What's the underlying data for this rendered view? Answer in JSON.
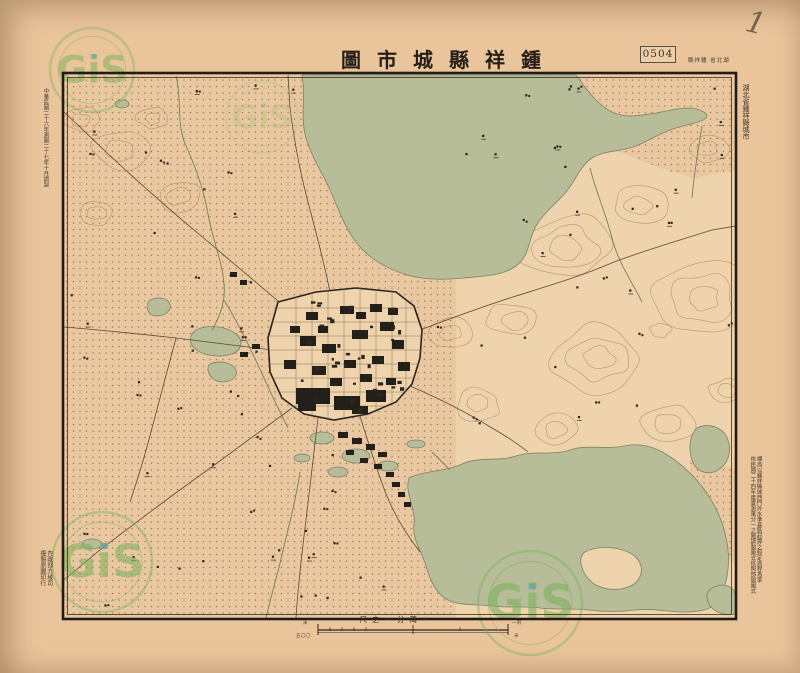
{
  "sheet": {
    "title": "鍾祥縣城市圖",
    "sheet_number": "0504",
    "series_note": "湖北省 鍾祥縣",
    "margin_top_right": "湖北省鍾祥縣城市",
    "margin_top_left": "中華民國二十六年測圖二十七年十月調製",
    "margin_right_note_col1": "標高以鍾祥縣城西門外水準基點起算之假定高程為準",
    "margin_right_note_col2": "依民國二十四年度實測萬分一之圖調製圖式依照部頒圖式",
    "margin_bottom_left_col1": "內政部方域司",
    "margin_bottom_left_col2": "複製原圖印行",
    "handwritten_mark": "1"
  },
  "scale_bar": {
    "caption": "一萬分一之尺",
    "left_label_top": "米",
    "left_label_bottom": "五〇〇",
    "right_label_top": "一粁",
    "right_label_bottom": "米"
  },
  "watermark": {
    "text": "GiS"
  },
  "colors": {
    "paper": "#eac59c",
    "land": "#eed3ad",
    "water": "#b6bd98",
    "contour": "#b2895c",
    "ink": "#28221b",
    "watermark_green": "#7db35e"
  }
}
